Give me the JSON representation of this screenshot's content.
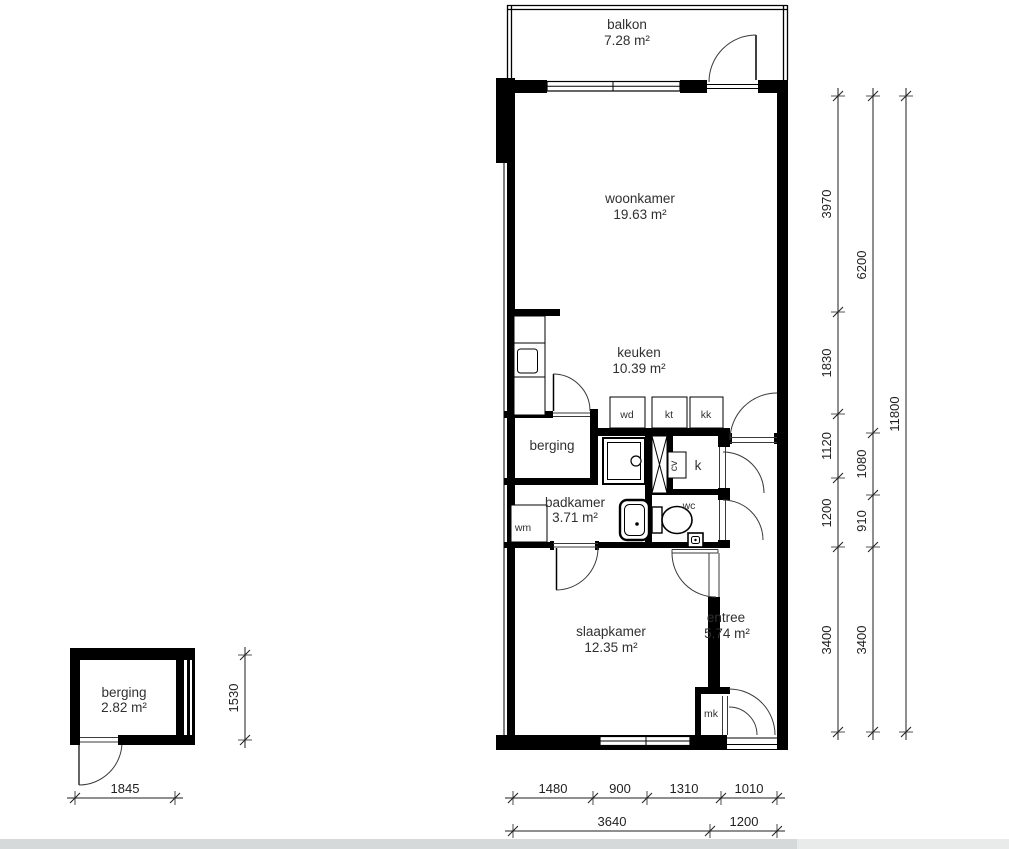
{
  "rooms": {
    "balkon": {
      "name": "balkon",
      "area": "7.28 m²"
    },
    "woonkamer": {
      "name": "woonkamer",
      "area": "19.63 m²"
    },
    "keuken": {
      "name": "keuken",
      "area": "10.39 m²"
    },
    "berging_binnen": {
      "name": "berging"
    },
    "badkamer": {
      "name": "badkamer",
      "area": "3.71 m²"
    },
    "wc": {
      "name": "wc"
    },
    "kast": {
      "name": "k"
    },
    "slaapkamer": {
      "name": "slaapkamer",
      "area": "12.35 m²"
    },
    "entree": {
      "name": "entree",
      "area": "5.74 m²"
    },
    "meterkast": {
      "name": "mk"
    },
    "berging_buiten": {
      "name": "berging",
      "area": "2.82 m²"
    }
  },
  "appliances": {
    "wd": "wd",
    "kt": "kt",
    "kk": "kk",
    "wm": "wm",
    "cv": "cv"
  },
  "dimensions": {
    "right_inner": [
      "3970",
      "1830",
      "1120",
      "1200",
      "3400"
    ],
    "right_middle": [
      "6200",
      "1080",
      "910",
      "3400"
    ],
    "right_outer": [
      "11800"
    ],
    "bottom_upper": [
      "1480",
      "900",
      "1310",
      "1010"
    ],
    "bottom_lower": [
      "3640",
      "1200"
    ],
    "berging_width": "1845",
    "berging_depth": "1530"
  },
  "colors": {
    "wall": "#000000",
    "text": "#303030",
    "dimension_line": "#1f1f1f",
    "scrollbar_track": "#e9eaea",
    "scrollbar_thumb": "#d5d9da"
  }
}
